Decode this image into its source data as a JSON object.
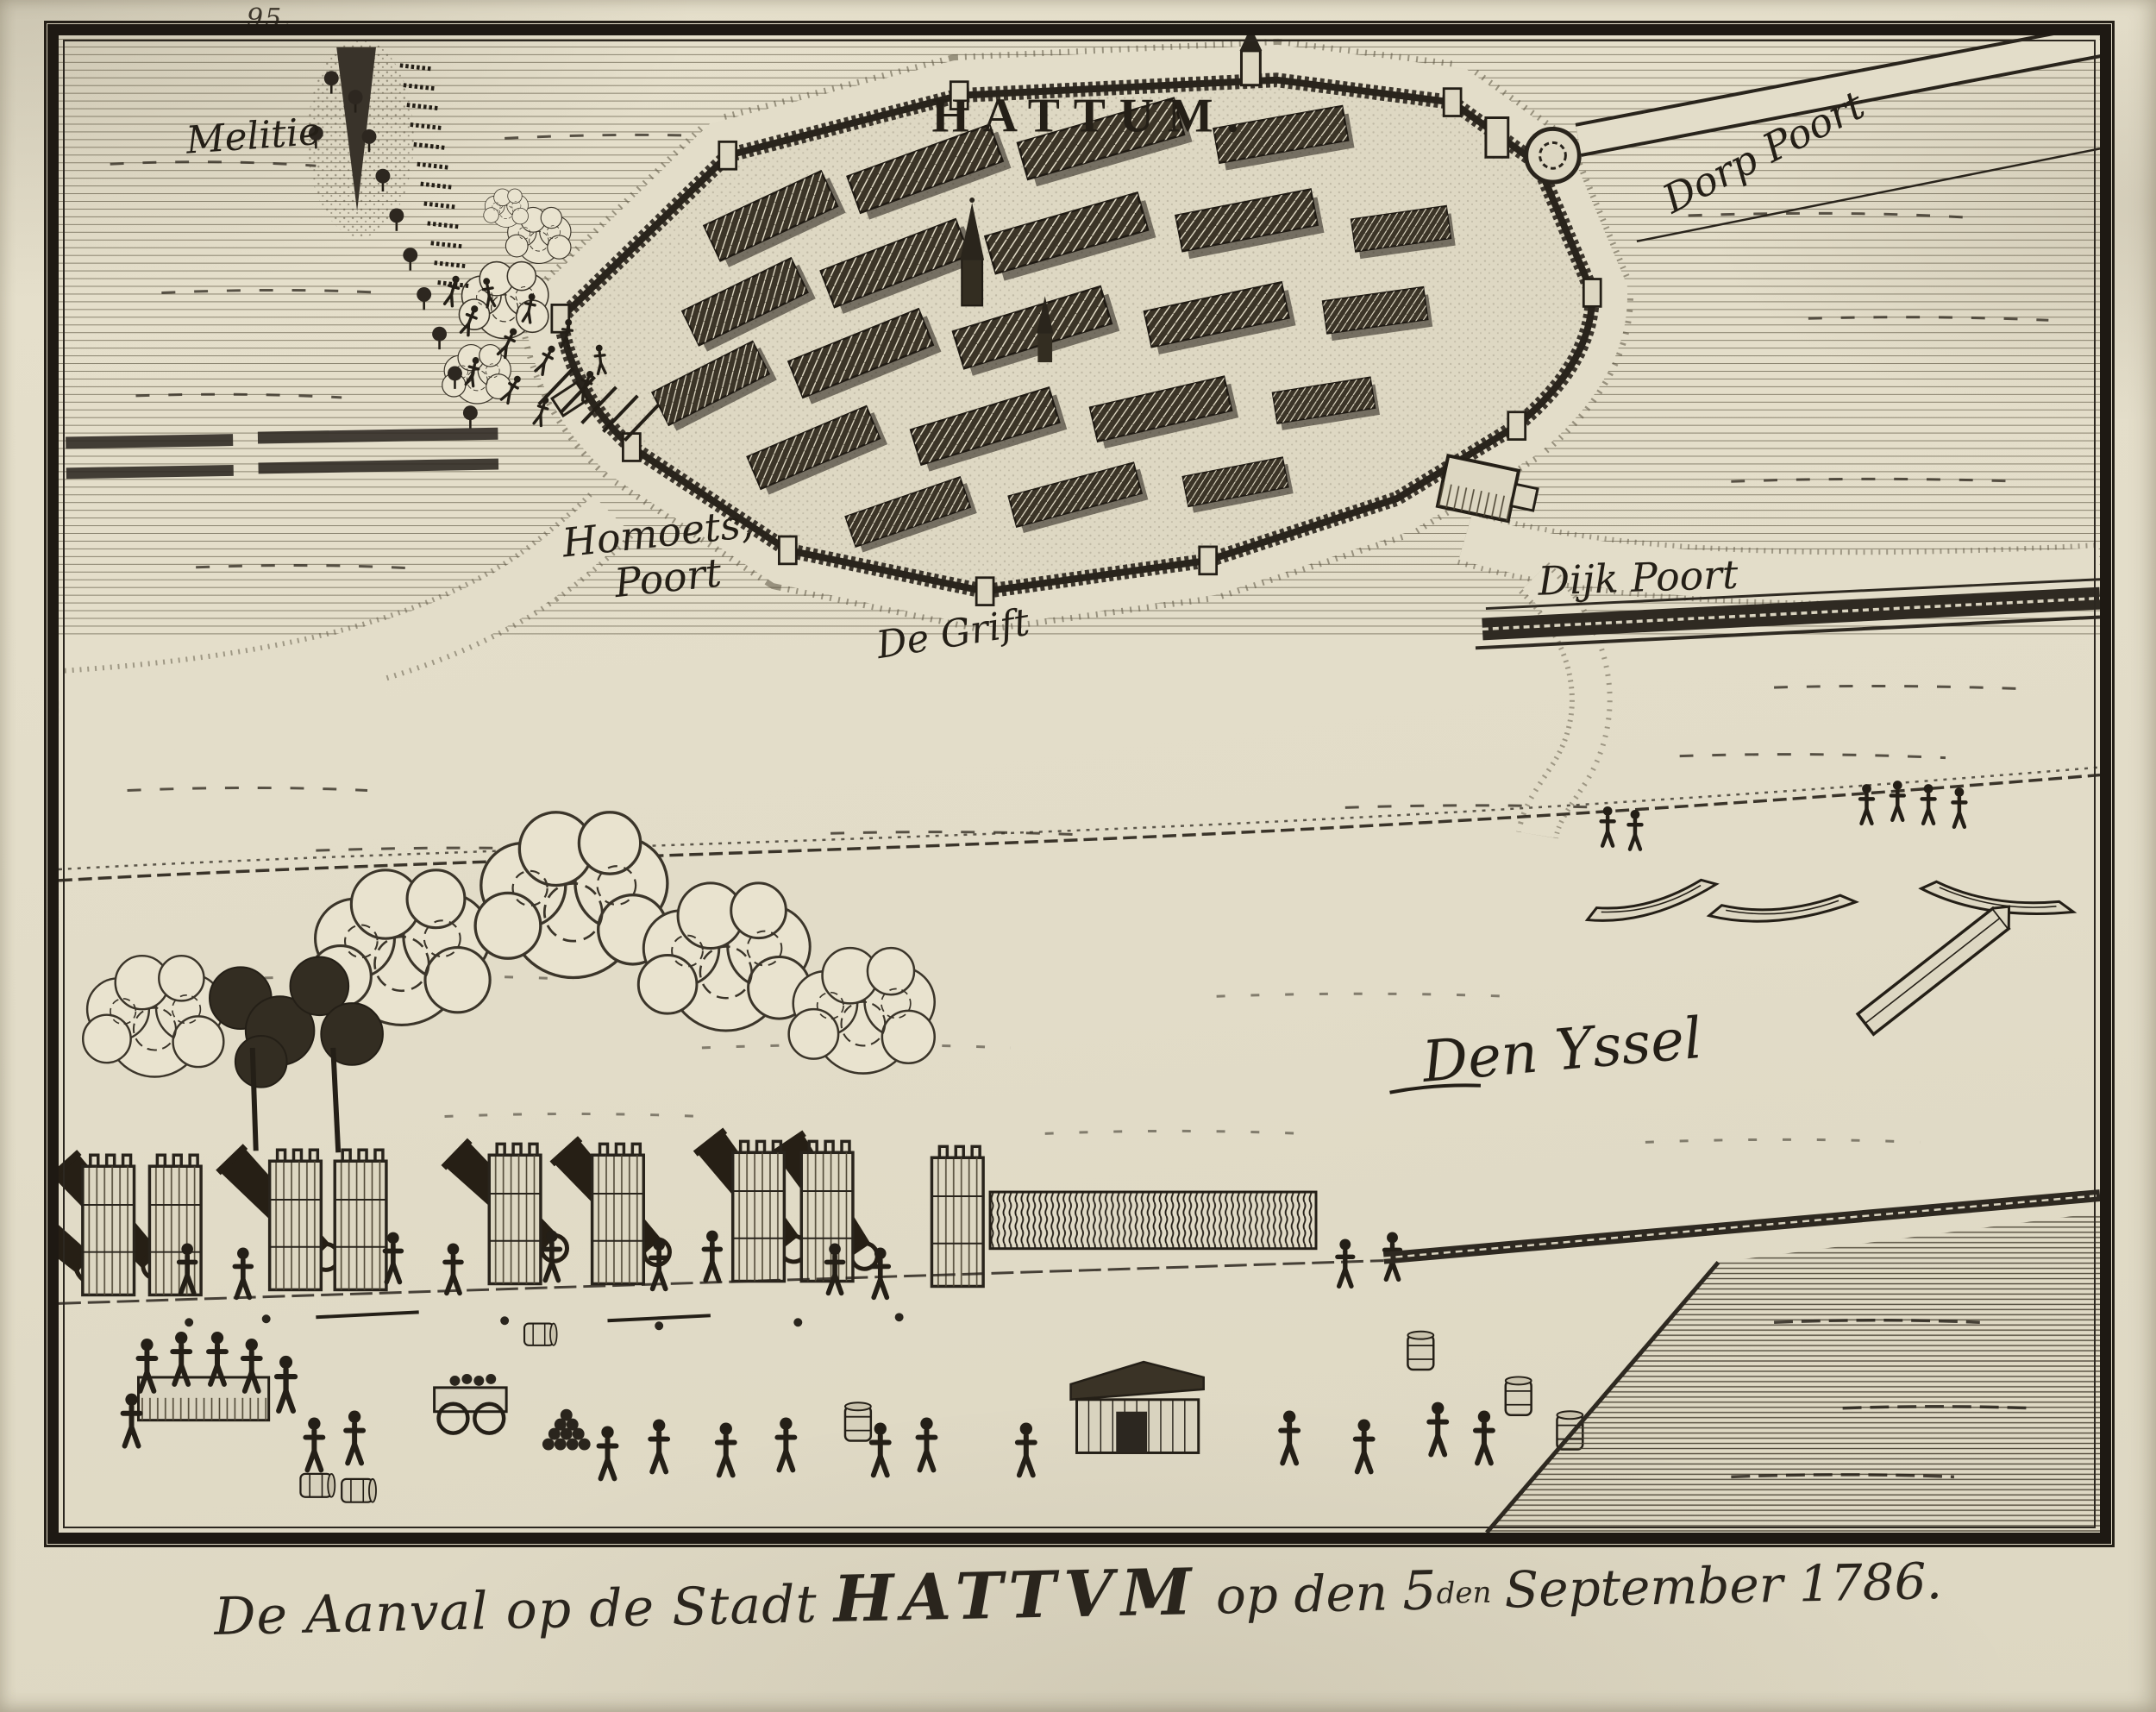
{
  "colors": {
    "paper": "#e2dcc8",
    "ink": "#241f17"
  },
  "margin": {
    "page_number": "95."
  },
  "map": {
    "title": "HATTUM.",
    "labels": {
      "melitie": "Melitie",
      "dorp_poort": "Dorp Poort",
      "homoets_line1": "Homoets,",
      "homoets_line2": "Poort",
      "de_grift": "De Grift",
      "dijk_poort": "Dijk Poort",
      "den_yssel": "Den Yssel"
    }
  },
  "caption": {
    "prefix": "De Aanval op de Stadt",
    "city": "HATTVM",
    "middle": "op den",
    "day": "5",
    "day_ordinal": "den",
    "suffix": "September 1786."
  }
}
